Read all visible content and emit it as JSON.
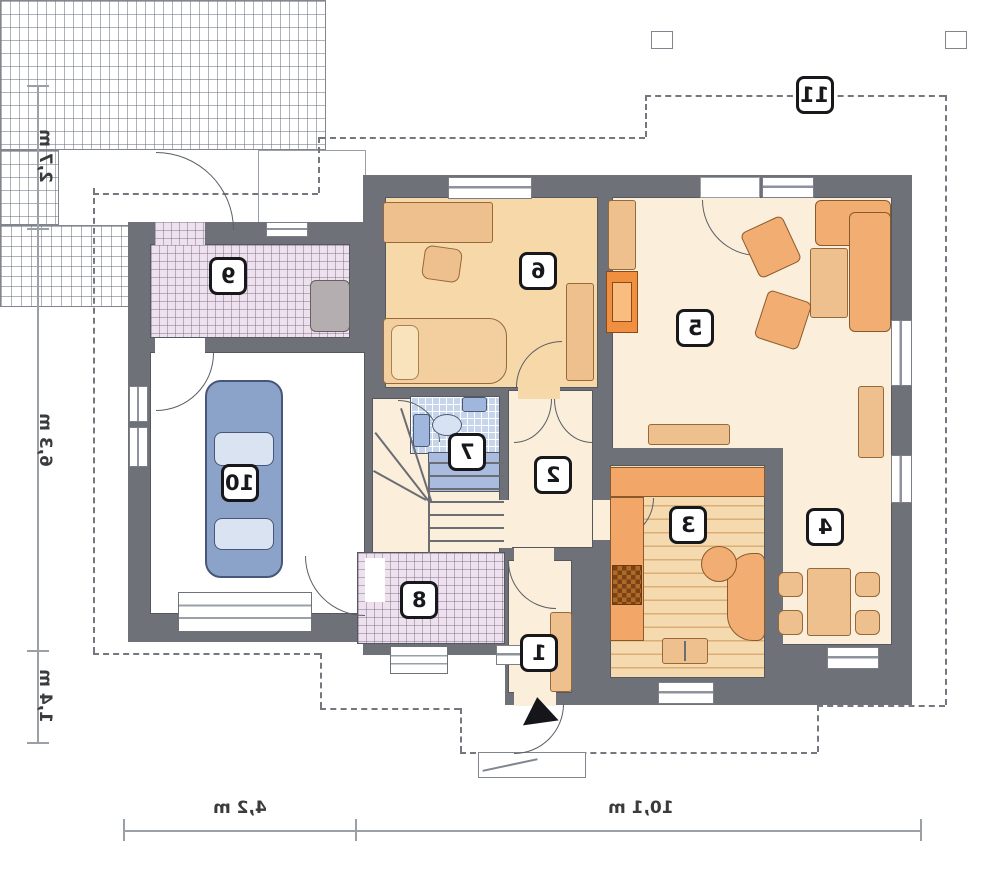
{
  "plan": {
    "type": "floor-plan-mirrored",
    "rooms": [
      {
        "number": "1"
      },
      {
        "number": "2"
      },
      {
        "number": "3"
      },
      {
        "number": "4"
      },
      {
        "number": "5"
      },
      {
        "number": "6"
      },
      {
        "number": "7"
      },
      {
        "number": "8"
      },
      {
        "number": "9"
      },
      {
        "number": "10"
      },
      {
        "number": "11"
      }
    ],
    "dimensions": {
      "left": [
        {
          "label": "2,7 m"
        },
        {
          "label": "6,3 m"
        },
        {
          "label": "1,4 m"
        }
      ],
      "bottom": [
        {
          "label": "4,2 m"
        },
        {
          "label": "10,1 m"
        }
      ]
    },
    "colors": {
      "wall": "#6e7178",
      "floor_cream": "#fbeeda",
      "floor_tan": "#f6d8a9",
      "furniture_tan": "#eec08e",
      "furniture_orange": "#f2ae72",
      "fireplace_orange": "#ef8f3f",
      "car_blue": "#8ba3c9",
      "bath_blue": "#c6d4ec",
      "tile_pink": "#ece1ec"
    }
  }
}
